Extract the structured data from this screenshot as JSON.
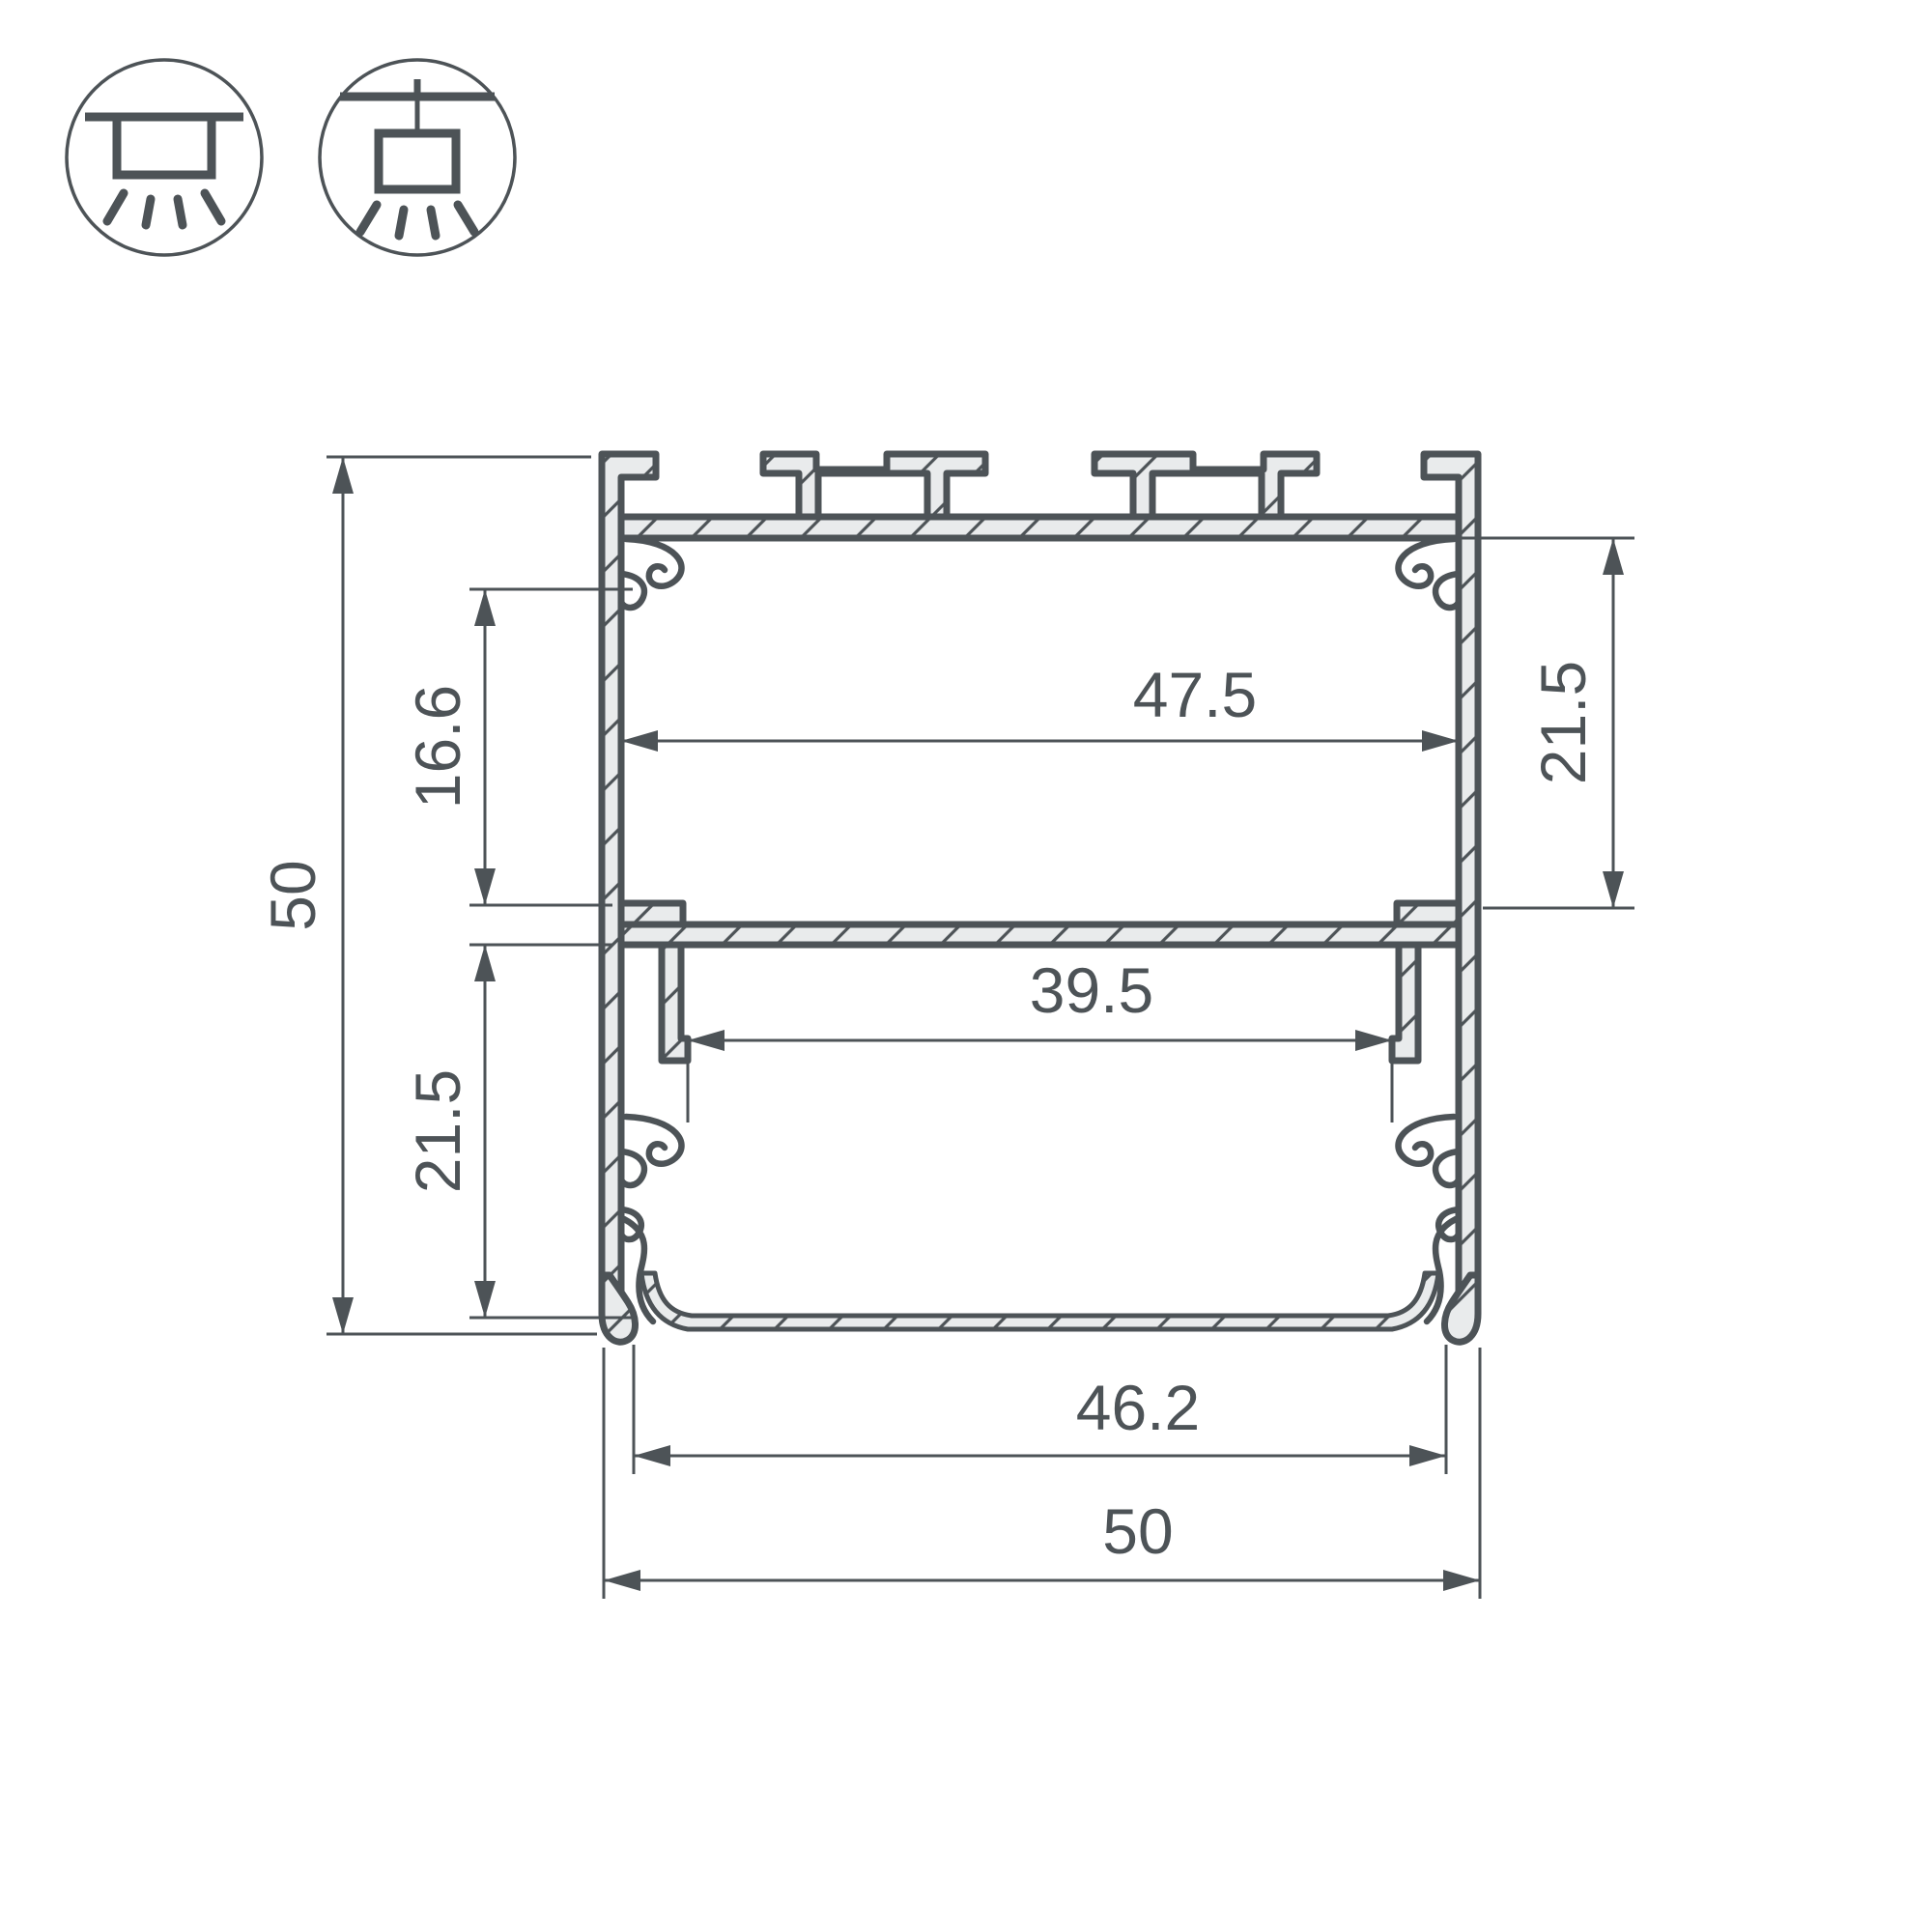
{
  "drawing": {
    "title": "Aluminium LED profile cross-section",
    "units": "mm",
    "colors": {
      "line": "#4d5357",
      "fill": "#e9ebec",
      "background": "#ffffff"
    },
    "mount_icons": [
      {
        "name": "surface-mount"
      },
      {
        "name": "pendant-mount"
      }
    ],
    "dimensions": {
      "overall_height": "50",
      "upper_chamber_depth": "16.6",
      "lower_chamber_depth": "21.5",
      "top_chamber_depth_right": "21.5",
      "inner_width_top": "47.5",
      "inner_width_between_hooks": "39.5",
      "diffuser_width": "46.2",
      "overall_width": "50"
    }
  }
}
